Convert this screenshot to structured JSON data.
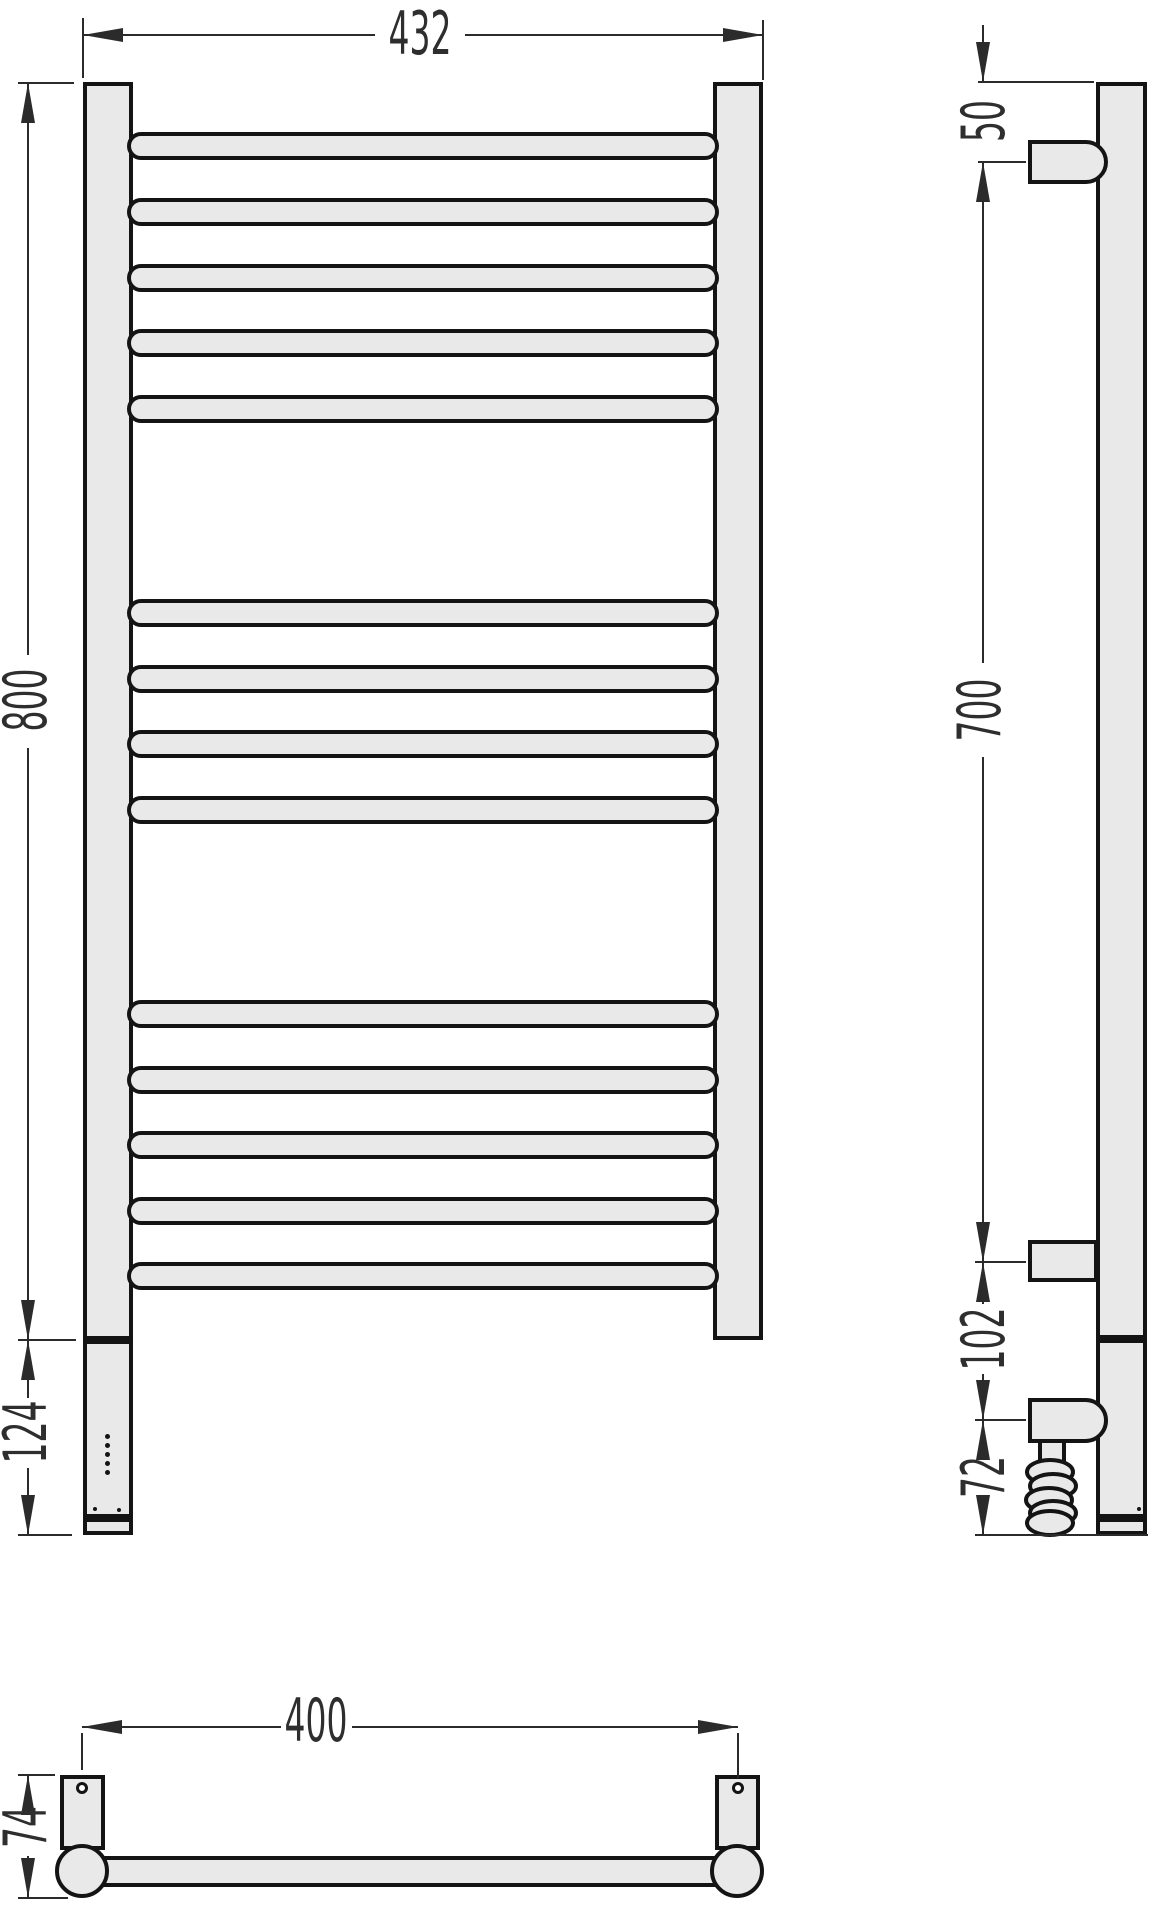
{
  "drawing": {
    "title": "heated-towel-rail-three-view-technical-drawing",
    "colors": {
      "background": "#ffffff",
      "fill": "#e9e9e9",
      "outline": "#141414",
      "dimension": "#2b2b2b"
    },
    "dimensions": {
      "overall_width": "432",
      "overall_height": "800",
      "control_box_height": "124",
      "top_to_bracket": "50",
      "bracket_spacing": "700",
      "bracket_to_heater": "102",
      "cable_zone": "72",
      "mount_hole_spacing": "400",
      "depth": "74"
    },
    "front_view": {
      "rung_tops": [
        132,
        198,
        264,
        329,
        395,
        599,
        665,
        730,
        796,
        1000,
        1066,
        1131,
        1197,
        1262
      ],
      "rung_groups": [
        5,
        4,
        5
      ],
      "led_dot_count": 5,
      "led_first_top": 1434,
      "led_step": 9
    }
  }
}
